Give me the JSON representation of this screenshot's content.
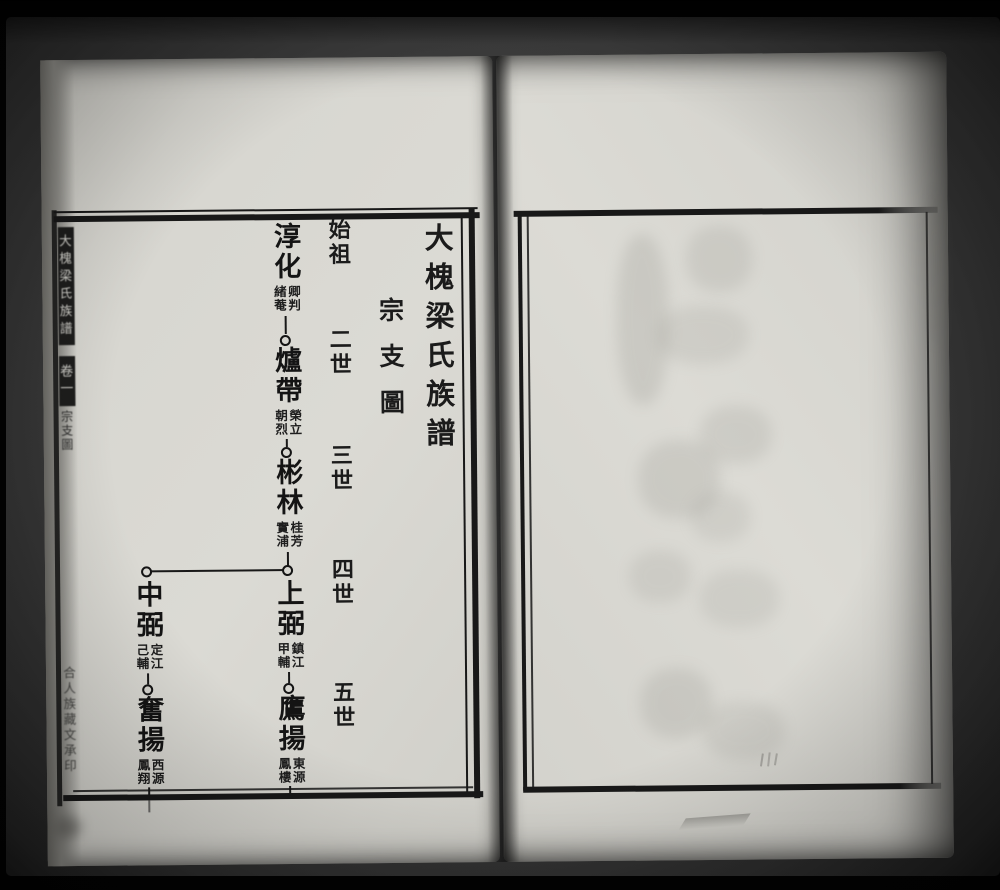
{
  "photo": {
    "background": "#020202",
    "bed_color": "#3a3a3a"
  },
  "book": {
    "left_page": {
      "paper_color": "#d7d6d0",
      "ink_color": "#161616",
      "spine": {
        "title": "大槐梁氏族譜",
        "volume": "卷一",
        "section": "宗支圖",
        "colophon": "合人族藏文承印"
      },
      "title": "大槐梁氏族譜",
      "section_title": "宗支圖",
      "generations": [
        "始祖",
        "二世",
        "三世",
        "四世",
        "五世"
      ],
      "tree": {
        "nodes": [
          {
            "name": "淳化",
            "note_right": "卿判",
            "note_left": "緒菴"
          },
          {
            "name": "爐帶",
            "note_right": "榮立",
            "note_left": "朝烈"
          },
          {
            "name": "彬林",
            "note_right": "桂芳",
            "note_left": "實浦"
          },
          {
            "name": "上弼",
            "note_right": "鎮江",
            "note_left": "甲輔"
          },
          {
            "name": "中弼",
            "note_right": "定江",
            "note_left": "己輔"
          },
          {
            "name": "鷹揚",
            "note_right": "東源",
            "note_left": "鳳樓"
          },
          {
            "name": "奮揚",
            "note_right": "西源",
            "note_left": "鳳翔"
          }
        ]
      }
    },
    "right_page": {
      "paper_color": "#dcdbd5"
    }
  }
}
